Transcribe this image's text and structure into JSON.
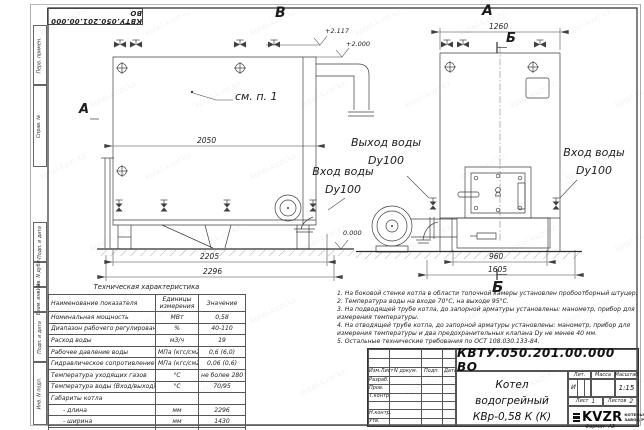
{
  "watermark": {
    "text": "kotel-kvzr.kz"
  },
  "frame": {
    "stamp_top": "КВТУ.050.201.00.000  ВО",
    "side_labels": [
      "Перв. примен.",
      "Справ. №",
      "Подп. и дата",
      "Инв. N дубл.",
      "Взам. инв. N",
      "Подп. и дата",
      "Инв. N подл."
    ]
  },
  "drawing": {
    "view_marker_top_left": "В",
    "view_marker_top_right": "А",
    "view_marker_left": "А",
    "section_marker_top": "Б",
    "section_marker_bottom": "Б",
    "callout_note": "см. п. 1",
    "levels": {
      "chimney": "+2.117",
      "boiler_top": "+2.000",
      "ground": "0.000"
    },
    "dimensions": {
      "side_width": "2050",
      "side_base": "2205",
      "side_overall": "2296",
      "front_width": "1260",
      "front_base": "960",
      "front_overall": "1605"
    },
    "pipe_labels": {
      "outlet_line1": "Выход воды",
      "outlet_line2": "Dy100",
      "inlet_left_line1": "Вход воды",
      "inlet_left_line2": "Dy100",
      "inlet_right_line1": "Вход воды",
      "inlet_right_line2": "Dy100"
    }
  },
  "spec_table": {
    "title": "Техническая характеристика",
    "headers": [
      "Наименование показателя",
      "Единицы измерения",
      "Значение"
    ],
    "rows": [
      [
        "Номинальная мощность",
        "МВт",
        "0,58"
      ],
      [
        "Диапазон рабочего регулирования",
        "%",
        "40-110"
      ],
      [
        "Расход воды",
        "м3/ч",
        "19"
      ],
      [
        "Рабочее давление воды",
        "МПа (кгс/см2)",
        "0,6 (6,0)"
      ],
      [
        "Гидравлическое сопротивление котла",
        "МПа (кгс/см2)",
        "0,06 (0,6)"
      ],
      [
        "Температура уходящих газов",
        "°С",
        "не более 280"
      ],
      [
        "Температура воды (Вход/выход)",
        "°С",
        "70/95"
      ],
      [
        "Габариты котла",
        "",
        ""
      ],
      [
        "- длина",
        "мм",
        "2296"
      ],
      [
        "- ширина",
        "мм",
        "1430"
      ],
      [
        "- высота",
        "мм",
        "2050"
      ]
    ]
  },
  "notes": [
    "1.  На боковой стенке котла в области топочной камеры установлен пробоотборный штуцер.",
    "2.  Температура воды на входе 70°С, на выходе 95°С.",
    "3.  На подводящей трубе котла, до запорной арматуры установлены: манометр, прибор для измерения температуры.",
    "4.  На отводящей трубе котла, до запорной арматуры установлены: манометр, прибор для измерения температуры и два предохранительных клапана Dу не менее 40 мм.",
    "5.  Остальные технические требования по ОСТ 108.030.133-84."
  ],
  "title_block": {
    "designation": "КВТУ.050.201.00.000  ВО",
    "name_line1": "Котел водогрейный",
    "name_line2": "КВр-0,58 К (К)",
    "columns": [
      "Изм.Лист",
      "N докум.",
      "Подп.",
      "Дата"
    ],
    "rows": [
      "Разраб.",
      "Пров.",
      "Т.контр.",
      "",
      "Н.контр.",
      "Утв."
    ],
    "lit_label": "Лит.",
    "lit_value": "И",
    "mass_label": "Масса",
    "scale_label": "Масштаб",
    "scale_value": "1:15",
    "sheet_label": "Лист",
    "sheet_value": "1",
    "sheets_label": "Листов",
    "sheets_value": "2",
    "logo_text": "KVZR",
    "logo_sub1": "КОТЕЛЬНЫЙ",
    "logo_sub2": "ЗАВОД РЭП",
    "format_label": "Формат",
    "format_value": "А3"
  }
}
